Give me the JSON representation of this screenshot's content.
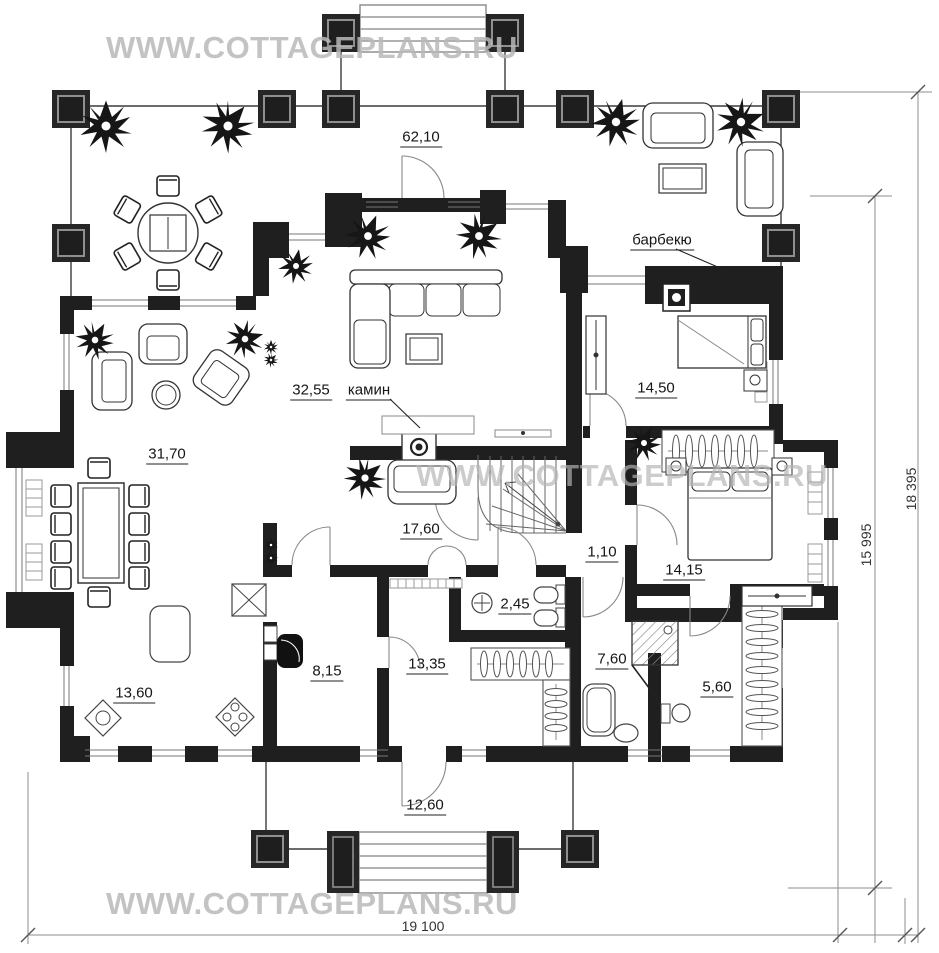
{
  "watermark": {
    "text": "WWW.COTTAGEPLANS.RU"
  },
  "annotations": {
    "fireplace": "камин",
    "barbecue": "барбекю"
  },
  "rooms": {
    "terrace": "62,10",
    "living": "32,55",
    "dining": "31,70",
    "hall": "17,60",
    "kitchen": "13,60",
    "bedroom_top": "14,50",
    "bedroom_right": "14,15",
    "corridor": "1,10",
    "bathroom_small": "2,45",
    "utility": "8,15",
    "guest": "13,35",
    "bathroom": "7,60",
    "wardrobe": "5,60",
    "veranda": "12,60"
  },
  "dimensions": {
    "width_bottom": "19 100",
    "height_outer": "18 395",
    "height_inner": "15 995"
  }
}
